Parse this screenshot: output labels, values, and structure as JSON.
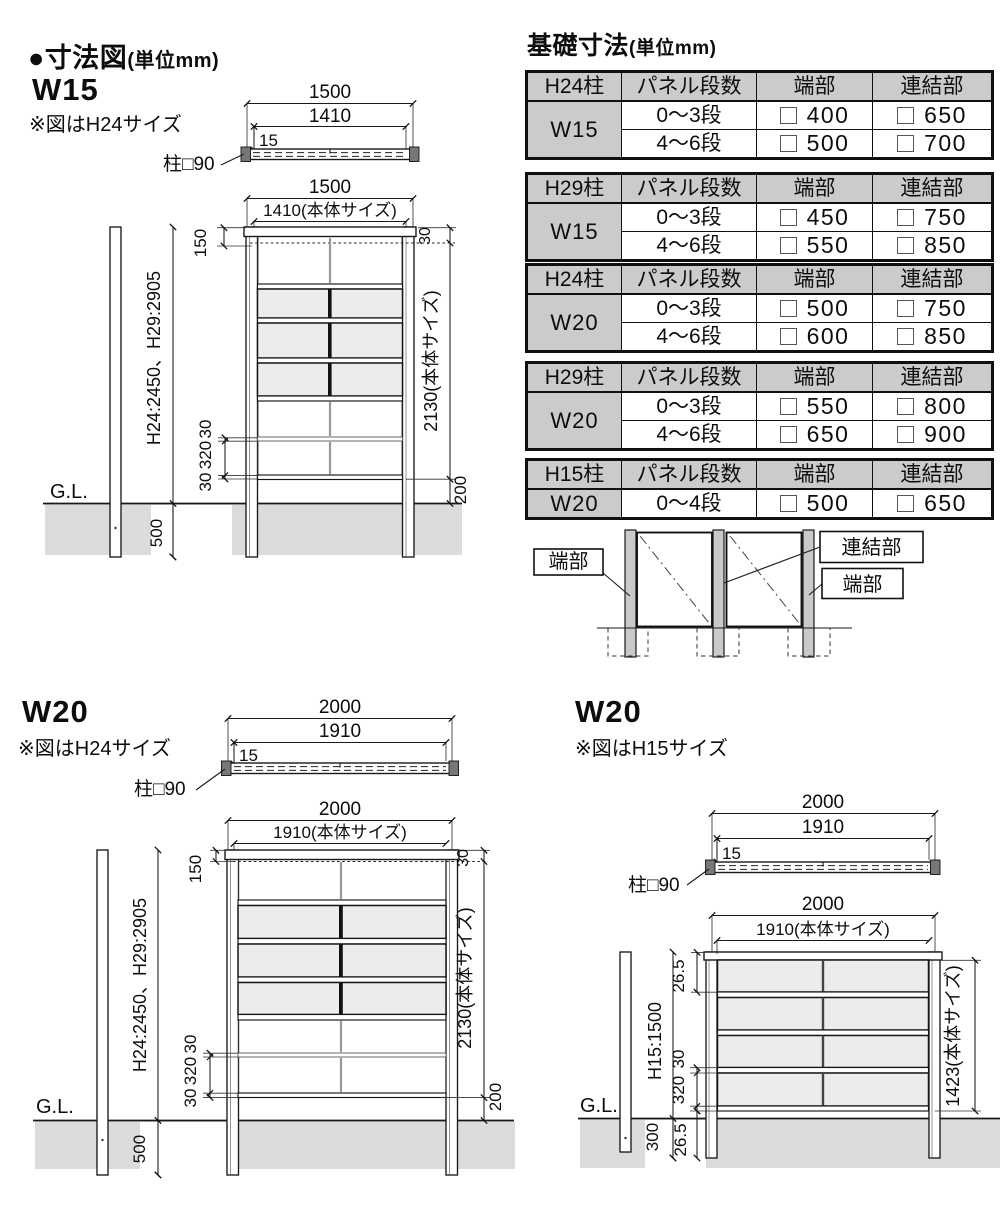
{
  "page": {
    "title": "●寸法図",
    "title_unit": "(単位mm)"
  },
  "sections": {
    "w15": {
      "label": "W15",
      "note": "※図はH24サイズ"
    },
    "w20a": {
      "label": "W20",
      "note": "※図はH24サイズ"
    },
    "w20b": {
      "label": "W20",
      "note": "※図はH15サイズ"
    }
  },
  "drawings": {
    "w15": {
      "top": {
        "overall": "1500",
        "body": "1410",
        "offset": "15",
        "post": "柱□90"
      },
      "front": {
        "overall": "1500",
        "body_w": "1410(本体サイズ)",
        "d150": "150",
        "d30top": "30",
        "height": "H24:2450、H29:2905",
        "d30a": "30",
        "d320": "320",
        "d30b": "30",
        "d500": "500",
        "gl": "G.L.",
        "body_h": "2130(本体サイズ)",
        "d200": "200"
      }
    },
    "w20a": {
      "top": {
        "overall": "2000",
        "body": "1910",
        "offset": "15",
        "post": "柱□90"
      },
      "front": {
        "overall": "2000",
        "body_w": "1910(本体サイズ)",
        "d150": "150",
        "d30top": "30",
        "height": "H24:2450、H29:2905",
        "d30a": "30",
        "d320": "320",
        "d30b": "30",
        "d500": "500",
        "gl": "G.L.",
        "body_h": "2130(本体サイズ)",
        "d200": "200"
      }
    },
    "w20b": {
      "top": {
        "overall": "2000",
        "body": "1910",
        "offset": "15",
        "post": "柱□90"
      },
      "front": {
        "overall": "2000",
        "body_w": "1910(本体サイズ)",
        "d265top": "26.5",
        "height": "H15:1500",
        "d30": "30",
        "d320": "320",
        "d265bot": "26.5",
        "d300": "300",
        "gl": "G.L.",
        "body_h": "1423(本体サイズ)"
      }
    }
  },
  "foundation": {
    "title": "基礎寸法",
    "title_unit": "(単位mm)",
    "headers": {
      "panel": "パネル段数",
      "end": "端部",
      "joint": "連結部"
    },
    "tables": [
      {
        "post": "H24柱",
        "size": "W15",
        "rows": [
          {
            "steps": "0〜3段",
            "end": "400",
            "joint": "650"
          },
          {
            "steps": "4〜6段",
            "end": "500",
            "joint": "700"
          }
        ]
      },
      {
        "post": "H29柱",
        "size": "W15",
        "rows": [
          {
            "steps": "0〜3段",
            "end": "450",
            "joint": "750"
          },
          {
            "steps": "4〜6段",
            "end": "550",
            "joint": "850"
          }
        ]
      },
      {
        "post": "H24柱",
        "size": "W20",
        "rows": [
          {
            "steps": "0〜3段",
            "end": "500",
            "joint": "750"
          },
          {
            "steps": "4〜6段",
            "end": "600",
            "joint": "850"
          }
        ]
      },
      {
        "post": "H29柱",
        "size": "W20",
        "rows": [
          {
            "steps": "0〜3段",
            "end": "550",
            "joint": "800"
          },
          {
            "steps": "4〜6段",
            "end": "650",
            "joint": "900"
          }
        ]
      },
      {
        "post": "H15柱",
        "size": "W20",
        "rows": [
          {
            "steps": "0〜4段",
            "end": "500",
            "joint": "650"
          }
        ]
      }
    ]
  },
  "connection": {
    "end_left": "端部",
    "joint": "連結部",
    "end_right": "端部"
  },
  "colors": {
    "line": "#1a1a1a",
    "table_header_bg": "#cbcbcb",
    "panel_shade": "#ececec",
    "ground": "#dcdcdc",
    "post_gray": "#c9c9c9"
  }
}
